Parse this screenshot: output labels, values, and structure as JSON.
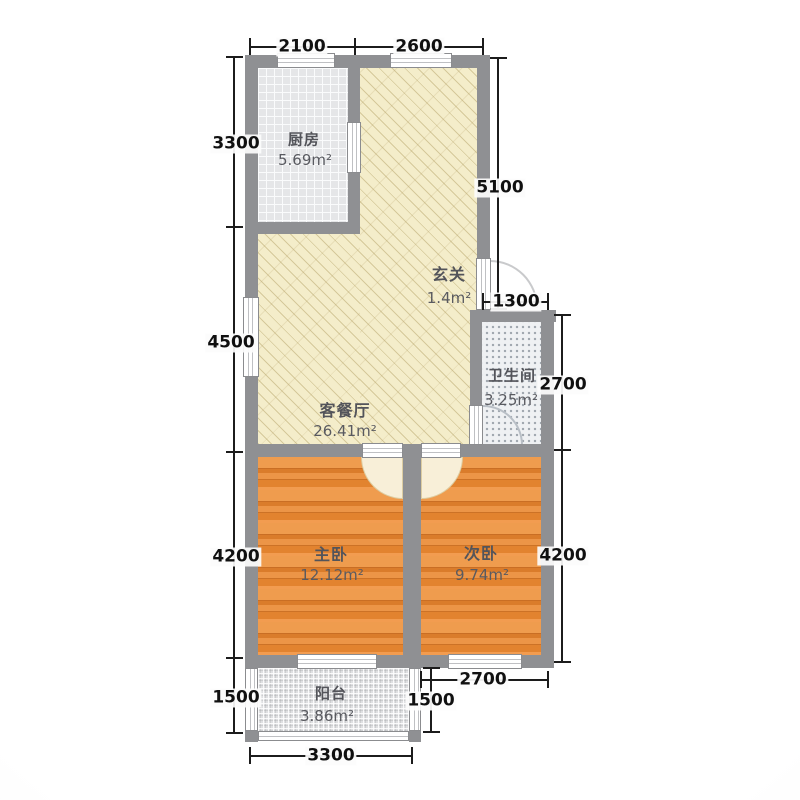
{
  "plan": {
    "title": "two-bedroom floor plan",
    "rooms": {
      "kitchen": {
        "name": "厨房",
        "area": "5.69m²"
      },
      "entry": {
        "name": "玄关",
        "area": "1.4m²"
      },
      "living": {
        "name": "客餐厅",
        "area": "26.41m²"
      },
      "bath": {
        "name": "卫生间",
        "area": "3.25m²"
      },
      "master": {
        "name": "主卧",
        "area": "12.12m²"
      },
      "second": {
        "name": "次卧",
        "area": "9.74m²"
      },
      "balcony": {
        "name": "阳台",
        "area": "3.86m²"
      }
    },
    "dims": {
      "top_a": "2100",
      "top_b": "2600",
      "left_a": "3300",
      "left_b": "4500",
      "left_c": "4200",
      "left_d": "1500",
      "right_a": "5100",
      "bath_w": "1300",
      "bath_h": "2700",
      "right_b": "4200",
      "bottom_a": "2700",
      "bottom_b": "1500",
      "bottom_c": "3300"
    },
    "colors": {
      "wall": "#8f9093",
      "living_floor": "#f4edca",
      "bedroom_floor": "#e78a3b",
      "kitchen_floor": "#e5e6e8",
      "bath_floor": "#eff1f3",
      "balcony_floor": "#dfe0e2",
      "dimension_text": "#101010",
      "room_text": "#53545a"
    }
  }
}
